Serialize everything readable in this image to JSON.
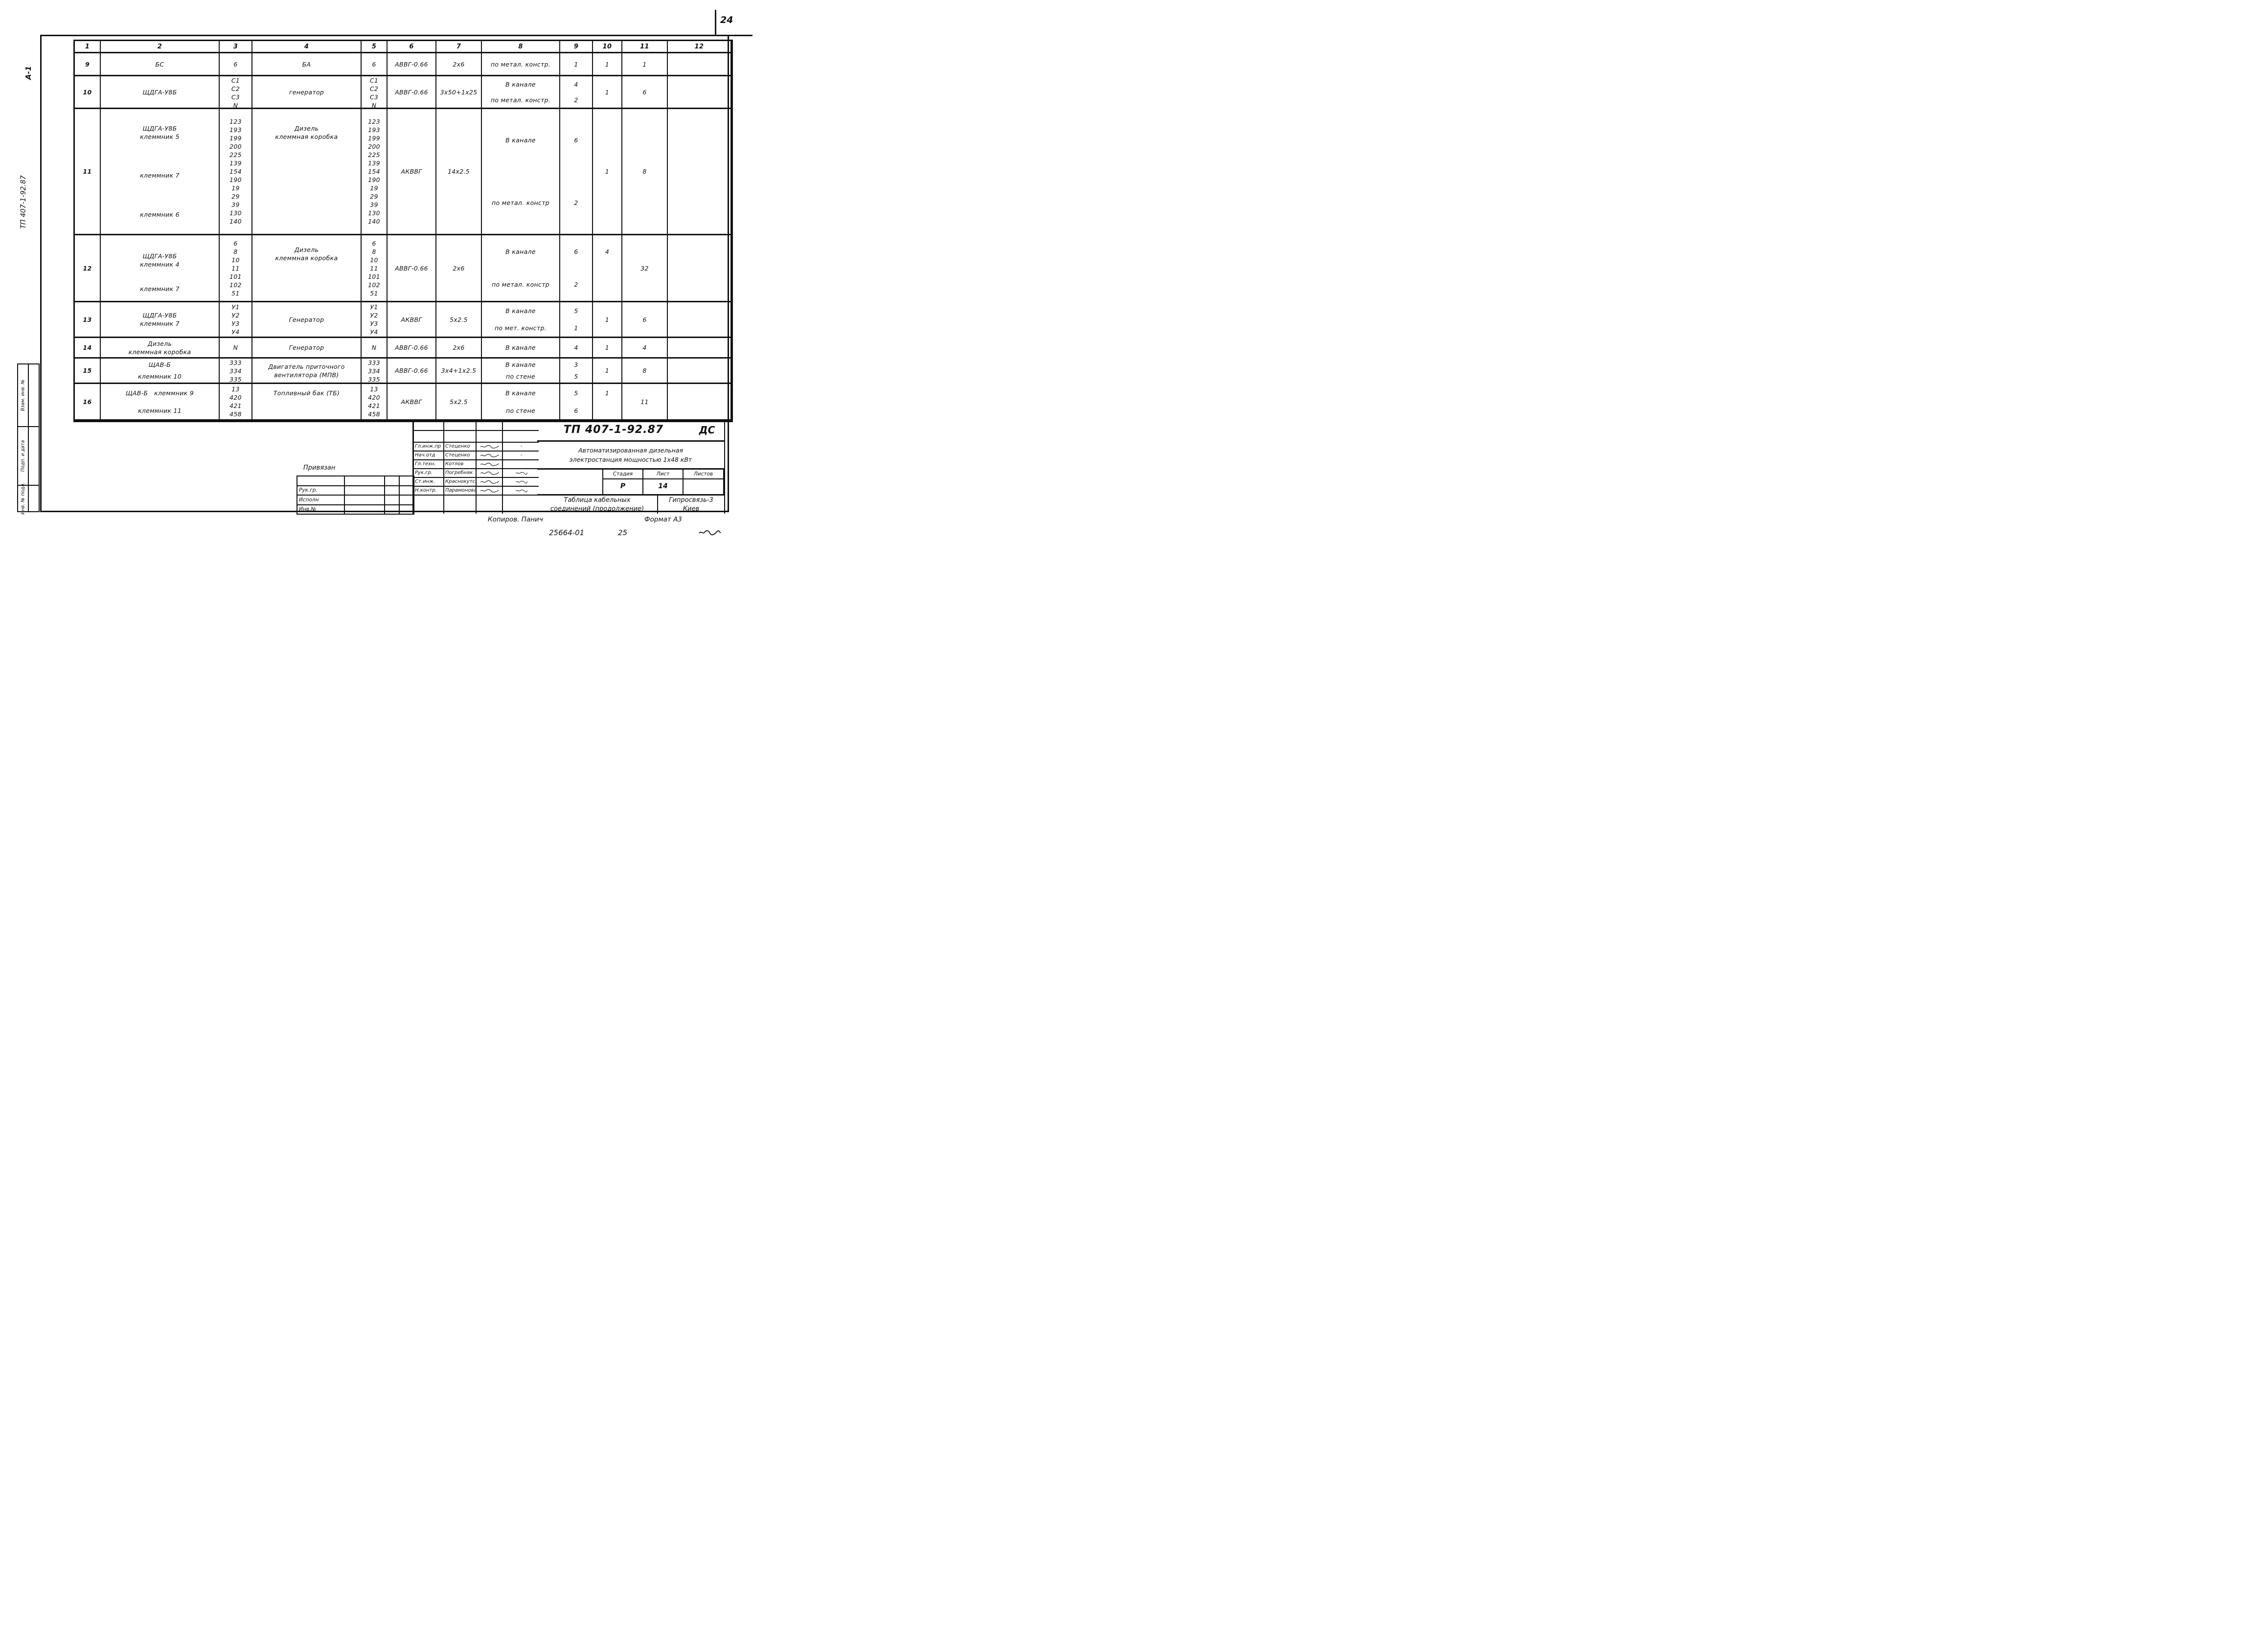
{
  "page": {
    "sheet_number": "24"
  },
  "margin": {
    "format_vertical": "А-1",
    "doc_code_vertical": "ТП 407-1-92.87",
    "stamp_cells": [
      "Взам. инв. №",
      "Подп. и дата",
      "Инв. № подл."
    ]
  },
  "table": {
    "headers": [
      "1",
      "2",
      "3",
      "4",
      "5",
      "6",
      "7",
      "8",
      "9",
      "10",
      "11",
      "12"
    ],
    "rows": [
      [
        "9",
        "БС",
        "6",
        "БА",
        "6",
        "АВВГ-0.66",
        "2х6",
        "по метал. констр.",
        "1",
        "1",
        "1",
        ""
      ],
      [
        "10",
        "ЩДГА-У8Б",
        "С1\nС2\nС3\nN",
        "генератор",
        "С1\nС2\nС3\nN",
        "АВВГ-0.66",
        "3х50+1х25",
        "В канале\n\nпо метал. констр.",
        "4\n\n2",
        "1",
        "6",
        ""
      ],
      [
        "11",
        "ЩДГА-У8Б\nклеммник 5\n\n\n\n\n\nклеммник 7\n\n\nклеммник 6",
        "123\n193\n199\n200\n225\n139\n154\n190\n19\n29\n39\n130\n140",
        "Дизель\nклеммная коробка\n\n \n\n ",
        "123\n193\n199\n200\n225\n139\n154\n190\n19\n29\n39\n130\n140",
        "АКВВГ",
        "14х2.5",
        "В канале\n\nпо метал. констр",
        "6\n\n2",
        "1",
        "8",
        ""
      ],
      [
        "12",
        " \nЩДГА-У8Б\nклеммник 4\n\n\n\nклеммник 7",
        "6\n8\n10\n11\n101\n102\n51",
        "Дизель\nклеммная коробка\n\n ",
        "6\n8\n10\n11\n101\n102\n51",
        "АВВГ-0.66",
        "2х6",
        "В канале\n\nпо метал. констр",
        "6\n\n2",
        "4\n\n ",
        "32",
        ""
      ],
      [
        "13",
        "ЩДГА-У8Б\nклеммник 7",
        "У1\nУ2\nУ3\nУ4",
        "Генератор",
        "У1\nУ2\nУ3\nУ4",
        "АКВВГ",
        "5х2.5",
        "В канале\n\nпо мет. констр.",
        "5\n\n1",
        "1",
        "6",
        ""
      ],
      [
        "14",
        "Дизель\nклеммная коробка",
        "N",
        "Генератор",
        "N",
        "АВВГ-0.66",
        "2х6",
        "В канале",
        "4",
        "1",
        "4",
        ""
      ],
      [
        "15",
        "ЩАВ-Б\n\nклеммник 10",
        "333\n334\n335",
        "Двигатель приточного\nвентилятора (МПВ)",
        "333\n334\n335",
        "АВВГ-0.66",
        "3х4+1х2.5",
        "В канале\n\nпо стене",
        "3\n\n5",
        "1",
        "8",
        ""
      ],
      [
        "16",
        "ЩАВ-Б   клеммник 9\n\n\nклеммник 11",
        "13\n420\n421\n458",
        "Топливный бак (ТБ)\n\n ",
        "13\n420\n421\n458",
        "АКВВГ",
        "5х2.5",
        "В канале\n\nпо стене",
        "5\n\n6",
        "1\n\n ",
        "11",
        ""
      ]
    ]
  },
  "title_block": {
    "doc_number": "ТП 407-1-92.87",
    "doc_suffix": "ДС",
    "description_line1": "Автоматизированная дизельная",
    "description_line2": "электростанция мощностью 1х48 кВт",
    "stage_headers": [
      "Стадия",
      "Лист",
      "Листов"
    ],
    "stage_values": [
      "Р",
      "14",
      ""
    ],
    "title_line1": "Таблица кабельных",
    "title_line2": "соединений (продолжение)",
    "organization_line1": "Гипросвязь-3",
    "organization_line2": "Киев",
    "attachment_label": "Привязан",
    "attachment_rows": [
      "",
      "Рук.гр.",
      "Исполн",
      "Инв.№"
    ],
    "signatures": [
      {
        "role": "Гл.инж.пр",
        "name": "Стеценко",
        "date_mark": "-"
      },
      {
        "role": "Нач.отд",
        "name": "Стеценко",
        "date_mark": "-"
      },
      {
        "role": "Гл.техн.",
        "name": "Котлов",
        "date_mark": ""
      },
      {
        "role": "Рук.гр.",
        "name": "Погребняк",
        "date_mark": "~"
      },
      {
        "role": "Ст.инж.",
        "name": "Краснокутская",
        "date_mark": "~"
      },
      {
        "role": "Н.контр.",
        "name": "Парамонова",
        "date_mark": "~"
      }
    ]
  },
  "footer": {
    "copier": "Копиров. Панич",
    "format": "Формат А3",
    "order_number": "25664-01",
    "order_sheet": "25"
  },
  "icons": {
    "signature": "∿",
    "date_scribble": "∿"
  }
}
